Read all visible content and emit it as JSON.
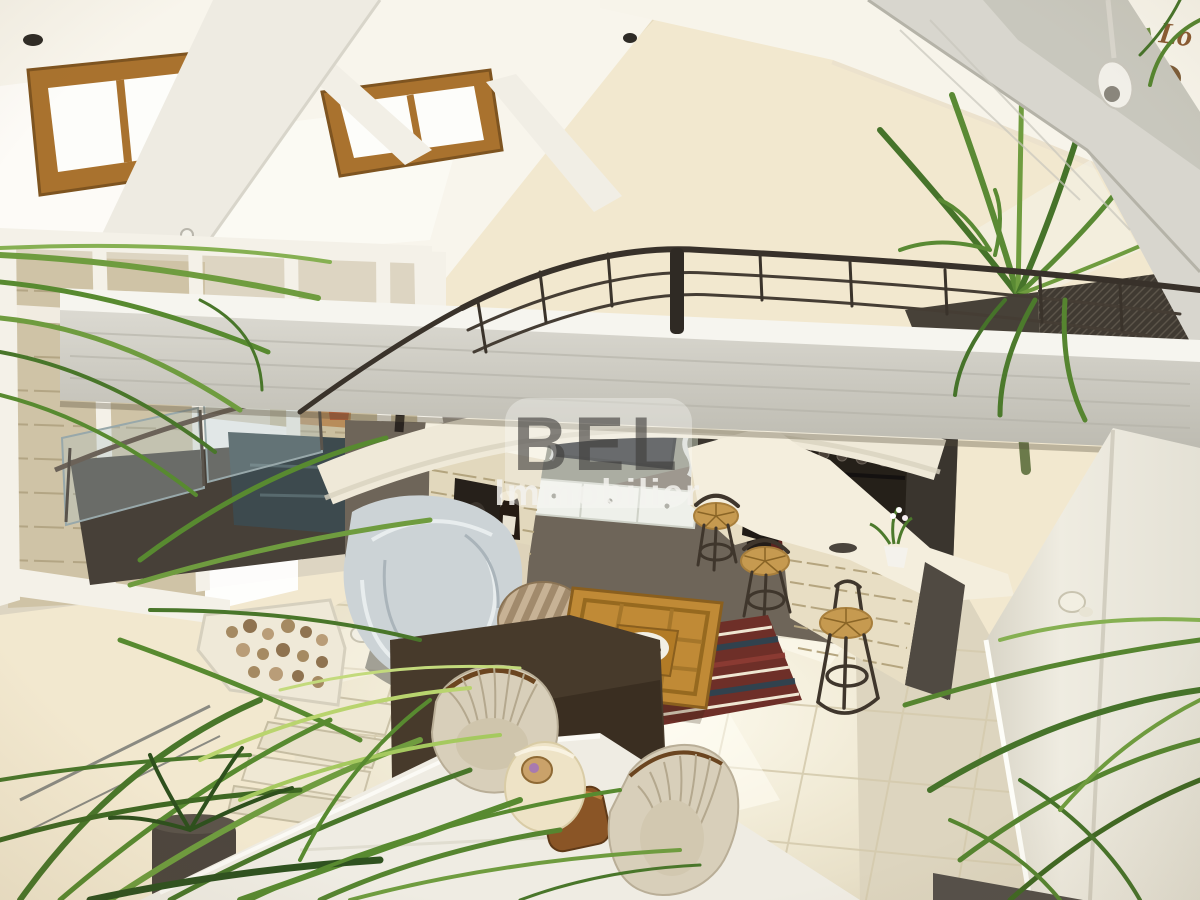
{
  "image": {
    "kind": "real-estate interior photograph",
    "description": "View from a mezzanine over a double-height living room: white painted beams, skylights, curved dark metal railing, stone bar with wicker stools, draped sofa, ribbed armchairs, square wooden coffee table on a striped rug, tiled floor, large green indoor palms and a yucca."
  },
  "watermark": {
    "line1": "BEL",
    "line2": "Immobilier",
    "line1_color": "#3f3d3b",
    "line2_color": "#f4f3ef"
  },
  "decor": {
    "wall_letters": "Lo"
  },
  "palette": {
    "cream_wall": "#f2e8cf",
    "ceiling_white": "#f8f5ec",
    "beam_gray": "#d3d1c8",
    "beam_light": "#efece3",
    "floor_tile": "#e9e1cb",
    "floor_right": "#ddd5bf",
    "railing_metal": "#38312a",
    "stone_bar": "#e7ddc3",
    "charcoal_wall": "#3a352e",
    "sage_wall": "#828476",
    "taupe_wall": "#6e6559",
    "table_wood": "#c08a36",
    "sofa_drape": "#ccd3d6",
    "armchair": "#d8cfba",
    "plant_green": "#5f8f33",
    "rug_red": "#6e2f28"
  }
}
